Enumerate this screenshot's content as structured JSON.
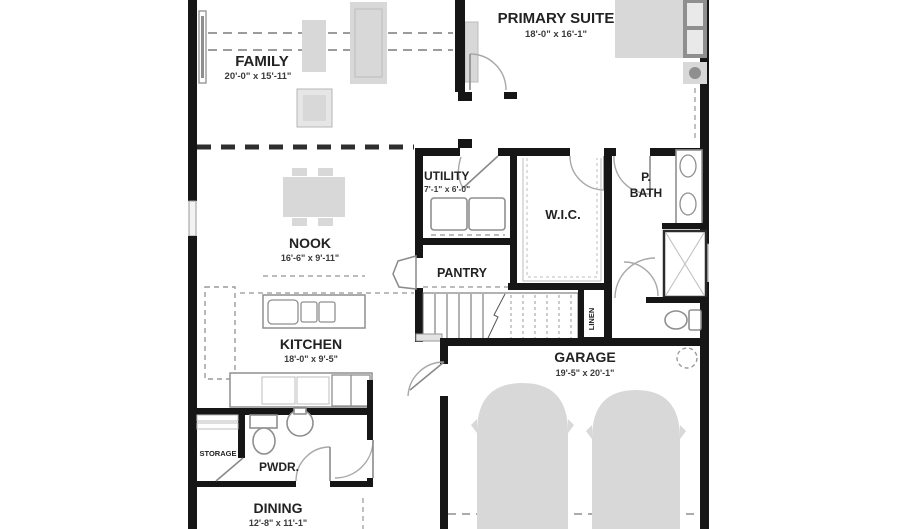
{
  "title": "Single-story floor plan",
  "colors": {
    "wall": "#161616",
    "furniture": "#d8d8d8",
    "furniture_dark": "#8f8f8f",
    "text": "#222222",
    "background": "#ffffff"
  },
  "rooms": {
    "family": {
      "name": "FAMILY",
      "dims": "20'-0\" x 15'-11\""
    },
    "primary_suite": {
      "name": "PRIMARY SUITE",
      "dims": "18'-0\" x 16'-1\""
    },
    "utility": {
      "name": "UTILITY",
      "dims": "7'-1\" x 6'-0\""
    },
    "wic": {
      "name": "W.I.C."
    },
    "primary_bath": {
      "name_line1": "P.",
      "name_line2": "BATH"
    },
    "nook": {
      "name": "NOOK",
      "dims": "16'-6\" x 9'-11\""
    },
    "pantry": {
      "name": "PANTRY"
    },
    "kitchen": {
      "name": "KITCHEN",
      "dims": "18'-0\" x 9'-5\""
    },
    "linen": {
      "name": "LINEN"
    },
    "garage": {
      "name": "GARAGE",
      "dims": "19'-5\" x 20'-1\""
    },
    "storage": {
      "name": "STORAGE"
    },
    "powder": {
      "name": "PWDR."
    },
    "dining": {
      "name": "DINING",
      "dims": "12'-8\" x 11'-1\""
    }
  }
}
